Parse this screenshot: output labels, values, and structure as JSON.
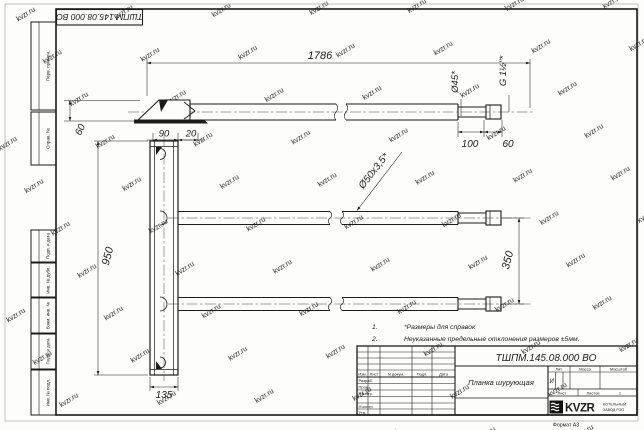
{
  "page": {
    "format_label": "Формат А3"
  },
  "watermark": {
    "text": "kvzr.ru"
  },
  "corner_stamp": {
    "doc_number": "ТШПМ.145.08.000 ВО"
  },
  "side_column": {
    "boxes": [
      "Перв. примен.",
      "Справ. №",
      "Подп. и дата",
      "Инв. № дубл.",
      "Взам. инв. №",
      "Подп. и дата",
      "Инв. № подл."
    ]
  },
  "drawing": {
    "dims": {
      "length": "1786",
      "tube_dia": "Ø50x3,5*",
      "end_dia": "Ø45*",
      "thread": "G 1½\"*",
      "end_len": "100",
      "fitting_len": "60",
      "blade_width": "60",
      "plank_w": "90",
      "plank_offset": "20",
      "plank_h": "950",
      "plank_base": "135",
      "tube_spacing": "350"
    },
    "notes": [
      {
        "num": "1.",
        "text": "*Размеры для справок"
      },
      {
        "num": "2.",
        "text": "Неуказанные предельные отклонения размеров ±5мм."
      }
    ]
  },
  "title_block": {
    "doc_number": "ТШПМ.145.08.000 ВО",
    "part_name": "Планка шурующая",
    "litera": "И",
    "sheets_value": "1",
    "headers": {
      "lit": "Лит.",
      "mass": "Масса",
      "scale": "Масштаб",
      "sheet": "Лист",
      "sheets": "Листов"
    },
    "columns": {
      "izm": "Изм.",
      "list": "Лист",
      "doc": "N докум.",
      "sign": "Подп.",
      "date": "Дата"
    },
    "rows": {
      "razrab": "Разраб.",
      "prov": "Пров.",
      "tkontr": "Т.контр.",
      "nkontr": "Н.контр.",
      "utv": "Утв."
    },
    "logo": {
      "name": "KVZR",
      "line1": "КОТЕЛЬНЫЙ",
      "line2": "ЗАВОД РЭП"
    }
  }
}
